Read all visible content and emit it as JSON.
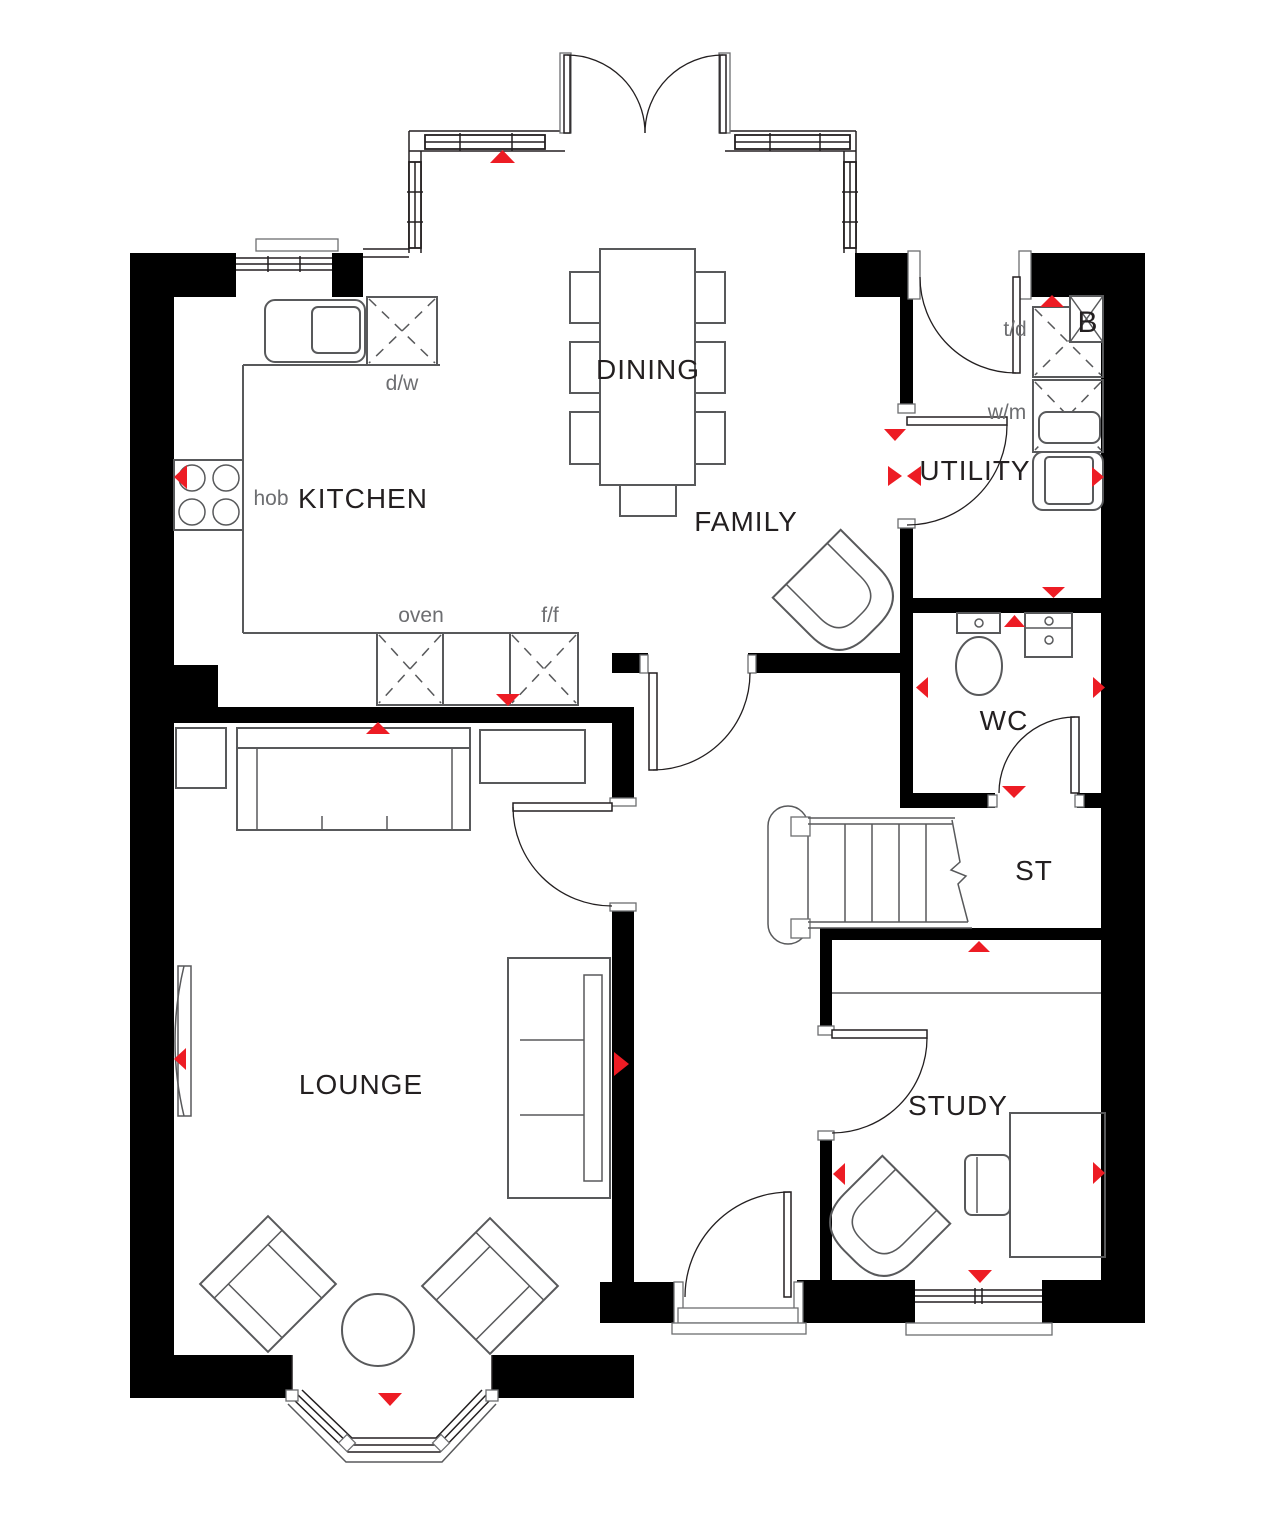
{
  "plan": {
    "title": "Ground floor plan",
    "colors": {
      "wall": "#000000",
      "marker": "#ed1c24",
      "fixture_line": "#58595b",
      "door_line": "#231f20",
      "room_label": "#231f20",
      "appliance_label": "#6d6e71"
    },
    "rooms": {
      "kitchen": {
        "label": "KITCHEN"
      },
      "dining": {
        "label": "DINING"
      },
      "family": {
        "label": "FAMILY"
      },
      "utility": {
        "label": "UTILITY"
      },
      "wc": {
        "label": "WC"
      },
      "store": {
        "label": "ST"
      },
      "lounge": {
        "label": "LOUNGE"
      },
      "study": {
        "label": "STUDY"
      }
    },
    "appliances": {
      "hob": {
        "label": "hob"
      },
      "dishwasher": {
        "label": "d/w"
      },
      "oven": {
        "label": "oven"
      },
      "fridge_freezer": {
        "label": "f/f"
      },
      "washing_machine": {
        "label": "w/m"
      },
      "tumble_dryer": {
        "label": "t/d"
      },
      "boiler": {
        "label": "B"
      }
    }
  }
}
